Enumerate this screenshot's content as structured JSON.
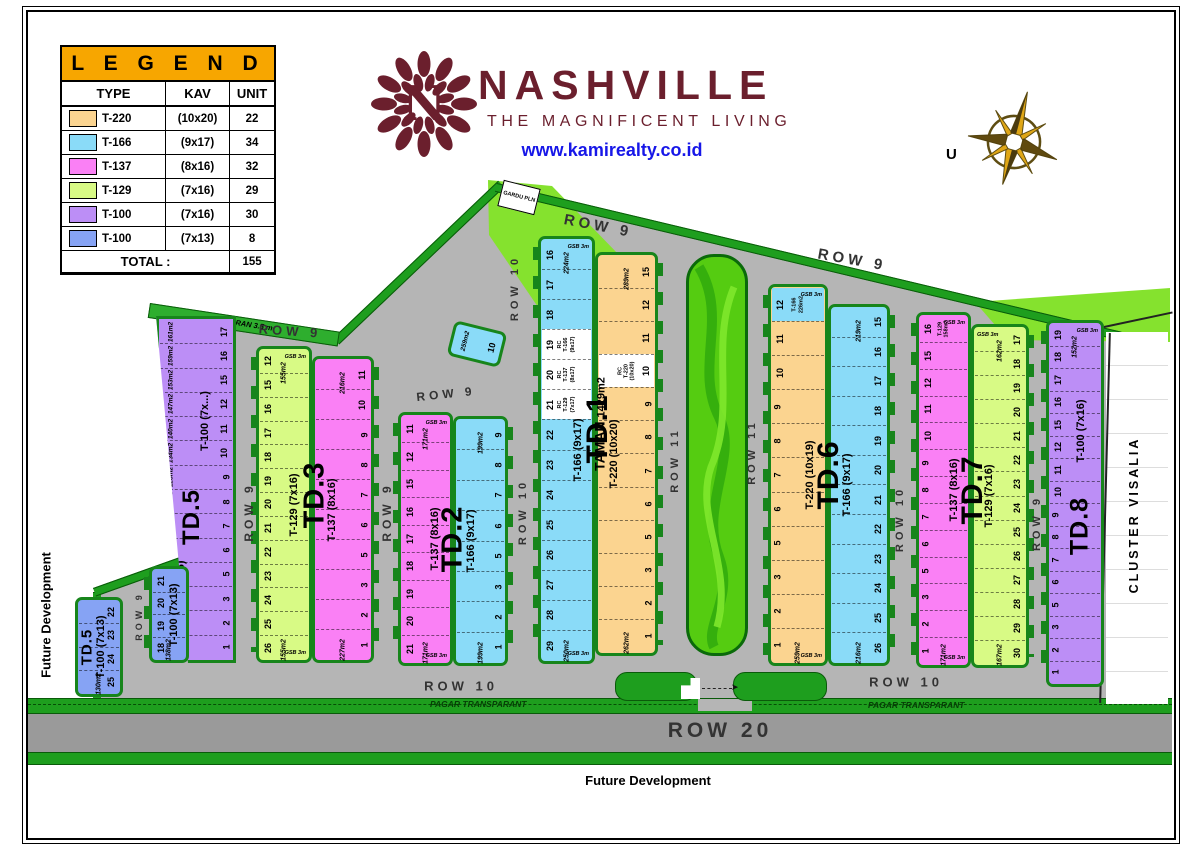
{
  "legend": {
    "title": "L E G E N D",
    "headers": [
      "TYPE",
      "KAV",
      "UNIT"
    ],
    "rows": [
      {
        "type": "T-220",
        "kav": "(10x20)",
        "unit": "22",
        "color": "#FBD490"
      },
      {
        "type": "T-166",
        "kav": "(9x17)",
        "unit": "34",
        "color": "#8ADBF8"
      },
      {
        "type": "T-137",
        "kav": "(8x16)",
        "unit": "32",
        "color": "#FA80F5"
      },
      {
        "type": "T-129",
        "kav": "(7x16)",
        "unit": "29",
        "color": "#D8FA85"
      },
      {
        "type": "T-100",
        "kav": "(7x16)",
        "unit": "30",
        "color": "#BC8EF6"
      },
      {
        "type": "T-100",
        "kav": "(7x13)",
        "unit": "8",
        "color": "#86A3F4"
      }
    ],
    "total_label": "TOTAL :",
    "total": "155"
  },
  "brand": {
    "name": "NASHVILLE",
    "tagline": "THE MAGNIFICENT LIVING",
    "website": "www.kamirealty.co.id",
    "monogram": "N",
    "color": "#6B1F2D",
    "link_color": "#1717E8"
  },
  "compass": {
    "label": "U"
  },
  "labels": {
    "future_dev": "Future Development",
    "saluran": "SALURAN 3.5 m",
    "gardu": "GARDU PLN",
    "pagar": "PAGAR TRANSPARANT",
    "taman": "TAMAN",
    "taman_area": "1429m2",
    "cluster": "CLUSTER VISALIA",
    "gsb": "GSB 3m"
  },
  "colors": {
    "orange": "#FBD490",
    "blue": "#8ADBF8",
    "pink": "#FA80F5",
    "yellow": "#D8FA85",
    "purple": "#BC8EF6",
    "blue2": "#86A3F4",
    "white": "#FFFFFF",
    "green": "#1E9E1E",
    "green_dark": "#0A5A0A",
    "light_green": "#85E22E",
    "road": "#B5B5B5",
    "road20": "#9A9A9A"
  },
  "road_labels": [
    {
      "t": "ROW 9",
      "x": 598,
      "y": 226,
      "r": 11,
      "s": 15
    },
    {
      "t": "ROW 9",
      "x": 852,
      "y": 260,
      "r": 10,
      "s": 15
    },
    {
      "t": "ROW 9",
      "x": 290,
      "y": 331,
      "r": 4,
      "s": 13
    },
    {
      "t": "ROW 9",
      "x": 446,
      "y": 394,
      "r": -6,
      "s": 12
    },
    {
      "t": "ROW 9",
      "x": 249,
      "y": 512,
      "r": -90,
      "s": 12
    },
    {
      "t": "ROW 9",
      "x": 387,
      "y": 512,
      "r": -90,
      "s": 12
    },
    {
      "t": "ROW 10",
      "x": 515,
      "y": 288,
      "r": -90,
      "s": 11
    },
    {
      "t": "ROW 10",
      "x": 523,
      "y": 512,
      "r": -90,
      "s": 11
    },
    {
      "t": "ROW 11",
      "x": 675,
      "y": 460,
      "r": -90,
      "s": 11
    },
    {
      "t": "ROW 11",
      "x": 752,
      "y": 452,
      "r": -90,
      "s": 11
    },
    {
      "t": "ROW 10",
      "x": 900,
      "y": 519,
      "r": -90,
      "s": 11
    },
    {
      "t": "ROW 9",
      "x": 1037,
      "y": 523,
      "r": -90,
      "s": 11
    },
    {
      "t": "ROW 9",
      "x": 139,
      "y": 616,
      "r": -90,
      "s": 9
    },
    {
      "t": "ROW 10",
      "x": 461,
      "y": 686,
      "r": 0,
      "s": 13
    },
    {
      "t": "ROW 10",
      "x": 906,
      "y": 682,
      "r": 0,
      "s": 13
    },
    {
      "t": "ROW 20",
      "x": 720,
      "y": 731,
      "r": 0,
      "s": 21
    }
  ],
  "blocks": [
    {
      "id": "TD.5",
      "label": "TD.5",
      "x": 156,
      "y": 316,
      "w": 80,
      "h": 347,
      "label_size": 24,
      "bx": 45,
      "by": 58,
      "strips": [
        {
          "w": 80,
          "color": "purple",
          "num_side": "right",
          "clip": "polygon(0% 0%,100% 0%,100% 100%,40% 100%)",
          "type_label": "T-100 (7x...)",
          "tx": 62,
          "ty": 30,
          "type_label2": "T-100 (7x16)",
          "tx2": 30,
          "ty2": 80,
          "cells": [
            {
              "n": "17",
              "area": "161m2"
            },
            {
              "n": "16",
              "area": "159m2"
            },
            {
              "n": "15",
              "area": "153m2"
            },
            {
              "n": "12",
              "area": "147m2"
            },
            {
              "n": "11",
              "area": "140m2"
            },
            {
              "n": "10",
              "area": "134m2"
            },
            {
              "n": "9",
              "area": "128m2"
            },
            {
              "n": "8",
              "area": "121m2"
            },
            {
              "n": "7",
              "area": "115m2"
            },
            {
              "n": "6"
            },
            {
              "n": "5"
            },
            {
              "n": "3"
            },
            {
              "n": "2"
            },
            {
              "n": "1",
              "area": "211m2"
            }
          ]
        }
      ]
    },
    {
      "id": "TD.5A",
      "label": "",
      "x": 149,
      "y": 566,
      "w": 40,
      "h": 97,
      "label_size": 0,
      "strips": [
        {
          "w": 40,
          "color": "blue2",
          "num_side": "left",
          "type_label": "T-100 (7x13)",
          "tx": 66,
          "area_bottom": "138m2",
          "cells": [
            {
              "n": "21"
            },
            {
              "n": "20"
            },
            {
              "n": "19"
            },
            {
              "n": "18"
            }
          ]
        }
      ]
    },
    {
      "id": "TD.5B",
      "label": "TD.5",
      "x": 75,
      "y": 597,
      "w": 48,
      "h": 100,
      "label_size": 15,
      "bx": 24,
      "by": 50,
      "strips": [
        {
          "w": 48,
          "color": "blue2",
          "num_side": "right",
          "tabs": false,
          "type_label": "T-100 (7x13)",
          "tx": 55,
          "area_bottom": "130m2",
          "cells": [
            {
              "n": "22"
            },
            {
              "n": "23"
            },
            {
              "n": "24"
            },
            {
              "n": "25"
            }
          ]
        }
      ]
    },
    {
      "id": "TD.3",
      "label": "TD.3",
      "x": 256,
      "y": 340,
      "w": 118,
      "h": 323,
      "label_size": 29,
      "bx": 50,
      "by": 48,
      "strips": [
        {
          "w": 56,
          "dy": 6,
          "color": "yellow",
          "num_side": "left",
          "type_label": "T-129 (7x16)",
          "tx": 70,
          "gsb_top": true,
          "gsb_bottom": true,
          "area_top": "155m2",
          "area_bottom": "155m2",
          "cells": [
            {
              "n": "12"
            },
            {
              "n": "15"
            },
            {
              "n": "16"
            },
            {
              "n": "17"
            },
            {
              "n": "18"
            },
            {
              "n": "19"
            },
            {
              "n": "20"
            },
            {
              "n": "21"
            },
            {
              "n": "22"
            },
            {
              "n": "23"
            },
            {
              "n": "24"
            },
            {
              "n": "25"
            },
            {
              "n": "26"
            }
          ]
        },
        {
          "w": 62,
          "dy": 16,
          "color": "pink",
          "num_side": "right",
          "type_label": "T-137 (8x16)",
          "tx": 30,
          "area_top": "216m2",
          "area_bottom": "227m2",
          "cells": [
            {
              "n": "11"
            },
            {
              "n": "10"
            },
            {
              "n": "9"
            },
            {
              "n": "8"
            },
            {
              "n": "7"
            },
            {
              "n": "6"
            },
            {
              "n": "5"
            },
            {
              "n": "3"
            },
            {
              "n": "2"
            },
            {
              "n": "1"
            }
          ]
        }
      ]
    },
    {
      "id": "TD.2",
      "label": "TD.2",
      "x": 398,
      "y": 412,
      "w": 110,
      "h": 254,
      "label_size": 29,
      "bx": 50,
      "by": 50,
      "strips": [
        {
          "w": 55,
          "color": "pink",
          "num_side": "left",
          "type_label": "T-137 (8x16)",
          "tx": 70,
          "gsb_top": true,
          "gsb_bottom": true,
          "area_top": "171m2",
          "area_bottom": "171m2",
          "cells": [
            {
              "n": "11"
            },
            {
              "n": "12"
            },
            {
              "n": "15"
            },
            {
              "n": "16"
            },
            {
              "n": "17"
            },
            {
              "n": "18"
            },
            {
              "n": "19"
            },
            {
              "n": "20"
            },
            {
              "n": "21"
            }
          ]
        },
        {
          "w": 55,
          "dy": 4,
          "color": "blue",
          "num_side": "right",
          "type_label": "T-166 (9x17)",
          "tx": 30,
          "area_top": "199m2",
          "area_bottom": "199m2",
          "cells": [
            {
              "n": "9"
            },
            {
              "n": "8"
            },
            {
              "n": "7"
            },
            {
              "n": "6"
            },
            {
              "n": "5"
            },
            {
              "n": "3"
            },
            {
              "n": "2"
            },
            {
              "n": "1"
            }
          ]
        }
      ]
    },
    {
      "id": "TD2-10",
      "label": "",
      "x": 450,
      "y": 326,
      "w": 54,
      "h": 36,
      "label_size": 0,
      "rot": 14,
      "strips": [
        {
          "w": 54,
          "color": "blue",
          "num_side": "right",
          "tabs": false,
          "cells": [
            {
              "n": "10",
              "area": "259m2"
            }
          ]
        }
      ]
    },
    {
      "id": "TD.1",
      "label": "TD.1",
      "x": 538,
      "y": 236,
      "w": 120,
      "h": 428,
      "label_size": 30,
      "bx": 50,
      "by": 45,
      "strips": [
        {
          "w": 57,
          "color": "blue",
          "num_side": "left",
          "type_label": "T-166 (9x17)",
          "tx": 72,
          "gsb_top": true,
          "gsb_bottom": true,
          "area_top": "224m2",
          "area_bottom": "250m2",
          "cells": [
            {
              "n": "16"
            },
            {
              "n": "17"
            },
            {
              "n": "18"
            },
            {
              "n": "19",
              "white": true,
              "sub": "RC\nT-166\n(9x17)"
            },
            {
              "n": "20",
              "white": true,
              "sub": "RC\nT-137\n(8x17)"
            },
            {
              "n": "21",
              "white": true,
              "sub": "RC\nT-129\n(7x17)"
            },
            {
              "n": "22"
            },
            {
              "n": "23"
            },
            {
              "n": "24"
            },
            {
              "n": "25"
            },
            {
              "n": "26"
            },
            {
              "n": "27"
            },
            {
              "n": "28"
            },
            {
              "n": "29"
            }
          ]
        },
        {
          "w": 63,
          "dy": 16,
          "db": 8,
          "color": "orange",
          "num_side": "right",
          "type_label": "T-220 (10x20)",
          "tx": 28,
          "area_top": "289m2",
          "area_bottom": "262m2",
          "cells": [
            {
              "n": "15"
            },
            {
              "n": "12"
            },
            {
              "n": "11"
            },
            {
              "n": "10",
              "white": true,
              "sub": "RC\nT-220\n(10x20)"
            },
            {
              "n": "9"
            },
            {
              "n": "8"
            },
            {
              "n": "7"
            },
            {
              "n": "6"
            },
            {
              "n": "5"
            },
            {
              "n": "3"
            },
            {
              "n": "2"
            },
            {
              "n": "1"
            }
          ]
        }
      ]
    },
    {
      "id": "TD.6",
      "label": "TD.6",
      "x": 768,
      "y": 284,
      "w": 122,
      "h": 382,
      "label_size": 30,
      "bx": 50,
      "by": 50,
      "strips": [
        {
          "w": 60,
          "color": "orange",
          "num_side": "left",
          "type_label": "T-220 (10x19)",
          "tx": 72,
          "gsb_top": true,
          "gsb_bottom": true,
          "area_bottom": "259m2",
          "cells": [
            {
              "n": "12",
              "cellColor": "blue",
              "sub": "T-166\n226m2"
            },
            {
              "n": "11"
            },
            {
              "n": "10"
            },
            {
              "n": "9"
            },
            {
              "n": "8"
            },
            {
              "n": "7"
            },
            {
              "n": "6"
            },
            {
              "n": "5"
            },
            {
              "n": "3"
            },
            {
              "n": "2"
            },
            {
              "n": "1"
            }
          ]
        },
        {
          "w": 62,
          "dy": 20,
          "color": "blue",
          "num_side": "right",
          "type_label": "T-166 (9x17)",
          "tx": 28,
          "area_top": "219m2",
          "area_bottom": "216m2",
          "cells": [
            {
              "n": "15"
            },
            {
              "n": "16"
            },
            {
              "n": "17"
            },
            {
              "n": "18"
            },
            {
              "n": "19"
            },
            {
              "n": "20"
            },
            {
              "n": "21"
            },
            {
              "n": "22"
            },
            {
              "n": "23"
            },
            {
              "n": "24"
            },
            {
              "n": "25"
            },
            {
              "n": "26"
            }
          ]
        }
      ]
    },
    {
      "id": "TD.7",
      "label": "TD.7",
      "x": 916,
      "y": 312,
      "w": 113,
      "h": 356,
      "label_size": 30,
      "bx": 50,
      "by": 50,
      "strips": [
        {
          "w": 55,
          "color": "pink",
          "num_side": "left",
          "type_label": "T-137 (8x16)",
          "tx": 72,
          "gsb_top": true,
          "gsb_bottom": true,
          "area_bottom": "171m2",
          "cells": [
            {
              "n": "16",
              "sub": "T-129\n158m2"
            },
            {
              "n": "15"
            },
            {
              "n": "12"
            },
            {
              "n": "11"
            },
            {
              "n": "10"
            },
            {
              "n": "9"
            },
            {
              "n": "8"
            },
            {
              "n": "7"
            },
            {
              "n": "6"
            },
            {
              "n": "5"
            },
            {
              "n": "3"
            },
            {
              "n": "2"
            },
            {
              "n": "1"
            }
          ]
        },
        {
          "w": 58,
          "dy": 12,
          "color": "yellow",
          "num_side": "right",
          "type_label": "T-129 (7x16)",
          "tx": 28,
          "gsb_top": true,
          "area_top": "162m2",
          "area_bottom": "167m2",
          "cells": [
            {
              "n": "17"
            },
            {
              "n": "18"
            },
            {
              "n": "19"
            },
            {
              "n": "20"
            },
            {
              "n": "21"
            },
            {
              "n": "22"
            },
            {
              "n": "23"
            },
            {
              "n": "24"
            },
            {
              "n": "25"
            },
            {
              "n": "26"
            },
            {
              "n": "27"
            },
            {
              "n": "28"
            },
            {
              "n": "29"
            },
            {
              "n": "30"
            }
          ]
        }
      ]
    },
    {
      "id": "TD.8",
      "label": "TD.8",
      "x": 1046,
      "y": 320,
      "w": 58,
      "h": 367,
      "label_size": 25,
      "bx": 58,
      "by": 56,
      "strips": [
        {
          "w": 58,
          "color": "purple",
          "num_side": "left",
          "type_label": "T-100 (7x16)",
          "tx": 62,
          "ty": 30,
          "gsb_top": true,
          "area_top": "152m2",
          "cells": [
            {
              "n": "19"
            },
            {
              "n": "18"
            },
            {
              "n": "17"
            },
            {
              "n": "16"
            },
            {
              "n": "15"
            },
            {
              "n": "12"
            },
            {
              "n": "11"
            },
            {
              "n": "10"
            },
            {
              "n": "9"
            },
            {
              "n": "8"
            },
            {
              "n": "7"
            },
            {
              "n": "6"
            },
            {
              "n": "5"
            },
            {
              "n": "3"
            },
            {
              "n": "2"
            },
            {
              "n": "1"
            }
          ]
        }
      ]
    }
  ]
}
